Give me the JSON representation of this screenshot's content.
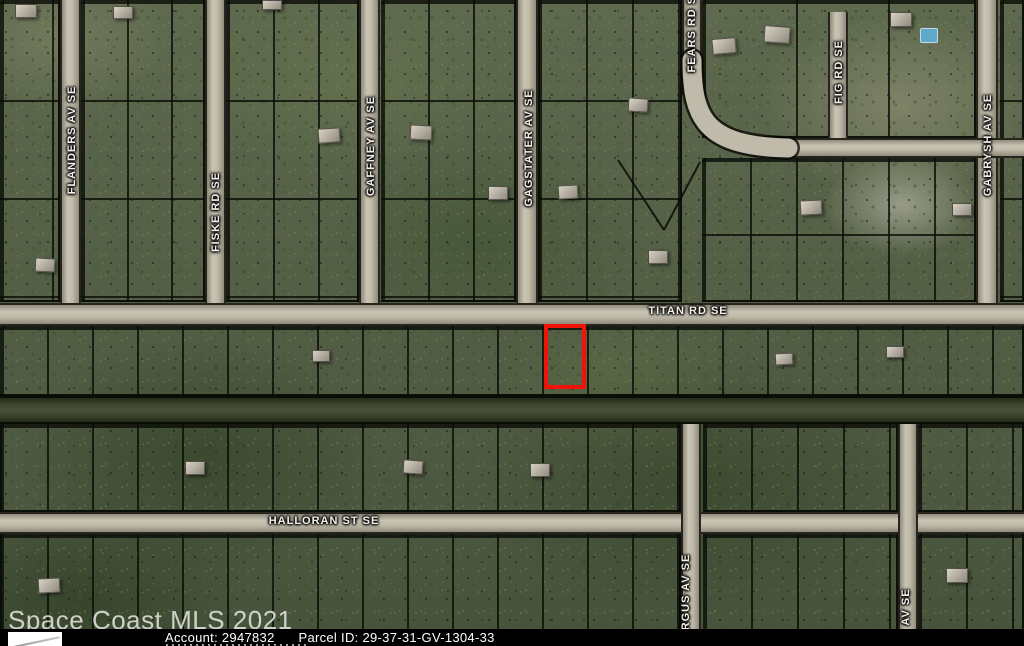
{
  "watermark": "Space Coast MLS 2021",
  "footer": {
    "account_label": "Account:",
    "account_value": "2947832",
    "parcel_label": "Parcel ID:",
    "parcel_value": "29-37-31-GV-1304-33"
  },
  "map": {
    "highlight": {
      "x": 544,
      "y": 324,
      "w": 42,
      "h": 65,
      "color": "#ef1309"
    },
    "labels": [
      {
        "text": "FLANDERS AV SE",
        "x": 72,
        "y": 140,
        "vertical": true
      },
      {
        "text": "FISKE RD SE",
        "x": 216,
        "y": 212,
        "vertical": true
      },
      {
        "text": "GAFFNEY AV SE",
        "x": 371,
        "y": 146,
        "vertical": true
      },
      {
        "text": "GAGSTATER AV SE",
        "x": 529,
        "y": 148,
        "vertical": true
      },
      {
        "text": "FEARS RD SE",
        "x": 692,
        "y": 30,
        "vertical": true
      },
      {
        "text": "FIG RD SE",
        "x": 839,
        "y": 72,
        "vertical": true
      },
      {
        "text": "GABRYSH AV SE",
        "x": 988,
        "y": 145,
        "vertical": true
      },
      {
        "text": "RGUS AV SE",
        "x": 686,
        "y": 592,
        "vertical": true
      },
      {
        "text": "AV SE",
        "x": 906,
        "y": 607,
        "vertical": true
      },
      {
        "text": "TITAN RD SE",
        "x": 688,
        "y": 311,
        "vertical": false
      },
      {
        "text": "HALLORAN ST SE",
        "x": 324,
        "y": 521,
        "vertical": false
      }
    ],
    "roads": [
      {
        "name": "flanders-av-road",
        "x": 60,
        "y": 0,
        "w": 21,
        "h": 326,
        "dir": "v"
      },
      {
        "name": "fiske-rd-road",
        "x": 205,
        "y": 0,
        "w": 21,
        "h": 326,
        "dir": "v"
      },
      {
        "name": "gaffney-av-road",
        "x": 359,
        "y": 0,
        "w": 21,
        "h": 326,
        "dir": "v"
      },
      {
        "name": "gagstater-av-road",
        "x": 516,
        "y": 0,
        "w": 22,
        "h": 326,
        "dir": "v"
      },
      {
        "name": "fears-rd-road",
        "x": 682,
        "y": 0,
        "w": 20,
        "h": 95,
        "dir": "v"
      },
      {
        "name": "fig-rd-road",
        "x": 828,
        "y": 12,
        "w": 20,
        "h": 146,
        "dir": "v"
      },
      {
        "name": "gabrysh-av-road",
        "x": 976,
        "y": 0,
        "w": 22,
        "h": 326,
        "dir": "v"
      },
      {
        "name": "upper-east-road",
        "x": 770,
        "y": 138,
        "w": 254,
        "h": 20,
        "dir": "h"
      },
      {
        "name": "titan-rd-road",
        "x": 0,
        "y": 303,
        "w": 1024,
        "h": 23,
        "dir": "h"
      },
      {
        "name": "halloran-st-road",
        "x": 0,
        "y": 512,
        "w": 1024,
        "h": 22,
        "dir": "h"
      },
      {
        "name": "rgus-av-road",
        "x": 681,
        "y": 424,
        "w": 20,
        "h": 222,
        "dir": "v"
      },
      {
        "name": "east-lower-road",
        "x": 898,
        "y": 424,
        "w": 20,
        "h": 222,
        "dir": "v"
      }
    ],
    "curve_road_path": "M 692 60 C 692 120 706 146 788 148",
    "diagonal_lot_lines": [
      "M 618 160 L 664 230",
      "M 664 230 L 700 162"
    ],
    "canal": {
      "x": 0,
      "y": 396,
      "w": 1024,
      "h": 28
    },
    "blocks": [
      {
        "x": 0,
        "y": 0,
        "w": 60,
        "h": 302,
        "cell_w": 50,
        "cell_h": 98
      },
      {
        "x": 81,
        "y": 0,
        "w": 124,
        "h": 302,
        "cell_w": 44,
        "cell_h": 98
      },
      {
        "x": 226,
        "y": 0,
        "w": 133,
        "h": 302,
        "cell_w": 45,
        "cell_h": 98
      },
      {
        "x": 381,
        "y": 0,
        "w": 135,
        "h": 302,
        "cell_w": 45,
        "cell_h": 98
      },
      {
        "x": 538,
        "y": 0,
        "w": 144,
        "h": 302,
        "cell_w": 46,
        "cell_h": 98
      },
      {
        "x": 702,
        "y": 0,
        "w": 274,
        "h": 138,
        "cell_w": 92,
        "cell_h": 140
      },
      {
        "x": 702,
        "y": 158,
        "w": 274,
        "h": 144,
        "cell_w": 46,
        "cell_h": 74
      },
      {
        "x": 1000,
        "y": 0,
        "w": 24,
        "h": 302,
        "cell_w": 26,
        "cell_h": 98
      },
      {
        "x": 0,
        "y": 326,
        "w": 1024,
        "h": 70,
        "cell_w": 45,
        "cell_h": 72
      },
      {
        "x": 0,
        "y": 424,
        "w": 681,
        "h": 88,
        "cell_w": 45,
        "cell_h": 90
      },
      {
        "x": 703,
        "y": 424,
        "w": 195,
        "h": 88,
        "cell_w": 46,
        "cell_h": 90
      },
      {
        "x": 918,
        "y": 424,
        "w": 106,
        "h": 88,
        "cell_w": 46,
        "cell_h": 90
      },
      {
        "x": 0,
        "y": 534,
        "w": 681,
        "h": 112,
        "cell_w": 45,
        "cell_h": 114
      },
      {
        "x": 703,
        "y": 534,
        "w": 195,
        "h": 112,
        "cell_w": 46,
        "cell_h": 114
      },
      {
        "x": 918,
        "y": 534,
        "w": 106,
        "h": 112,
        "cell_w": 46,
        "cell_h": 114
      }
    ],
    "houses": [
      [
        15,
        4,
        22,
        14,
        0
      ],
      [
        113,
        6,
        20,
        13,
        0
      ],
      [
        262,
        0,
        20,
        10,
        0
      ],
      [
        318,
        128,
        22,
        15,
        -4
      ],
      [
        410,
        125,
        22,
        15,
        3
      ],
      [
        488,
        186,
        20,
        14,
        0
      ],
      [
        558,
        185,
        20,
        14,
        -3
      ],
      [
        628,
        98,
        20,
        14,
        4
      ],
      [
        648,
        250,
        20,
        14,
        0
      ],
      [
        712,
        38,
        24,
        16,
        -5
      ],
      [
        764,
        26,
        26,
        17,
        4
      ],
      [
        890,
        12,
        22,
        15,
        0
      ],
      [
        800,
        200,
        22,
        15,
        -3
      ],
      [
        952,
        203,
        20,
        13,
        0
      ],
      [
        35,
        258,
        20,
        14,
        3
      ],
      [
        312,
        350,
        18,
        12,
        0
      ],
      [
        775,
        353,
        18,
        12,
        -3
      ],
      [
        886,
        346,
        18,
        12,
        0
      ],
      [
        185,
        461,
        20,
        14,
        0
      ],
      [
        403,
        460,
        20,
        14,
        4
      ],
      [
        530,
        463,
        20,
        14,
        0
      ],
      [
        38,
        578,
        22,
        15,
        -3
      ],
      [
        946,
        568,
        22,
        15,
        0
      ]
    ],
    "pool": {
      "x": 920,
      "y": 28,
      "w": 16,
      "h": 13
    }
  }
}
